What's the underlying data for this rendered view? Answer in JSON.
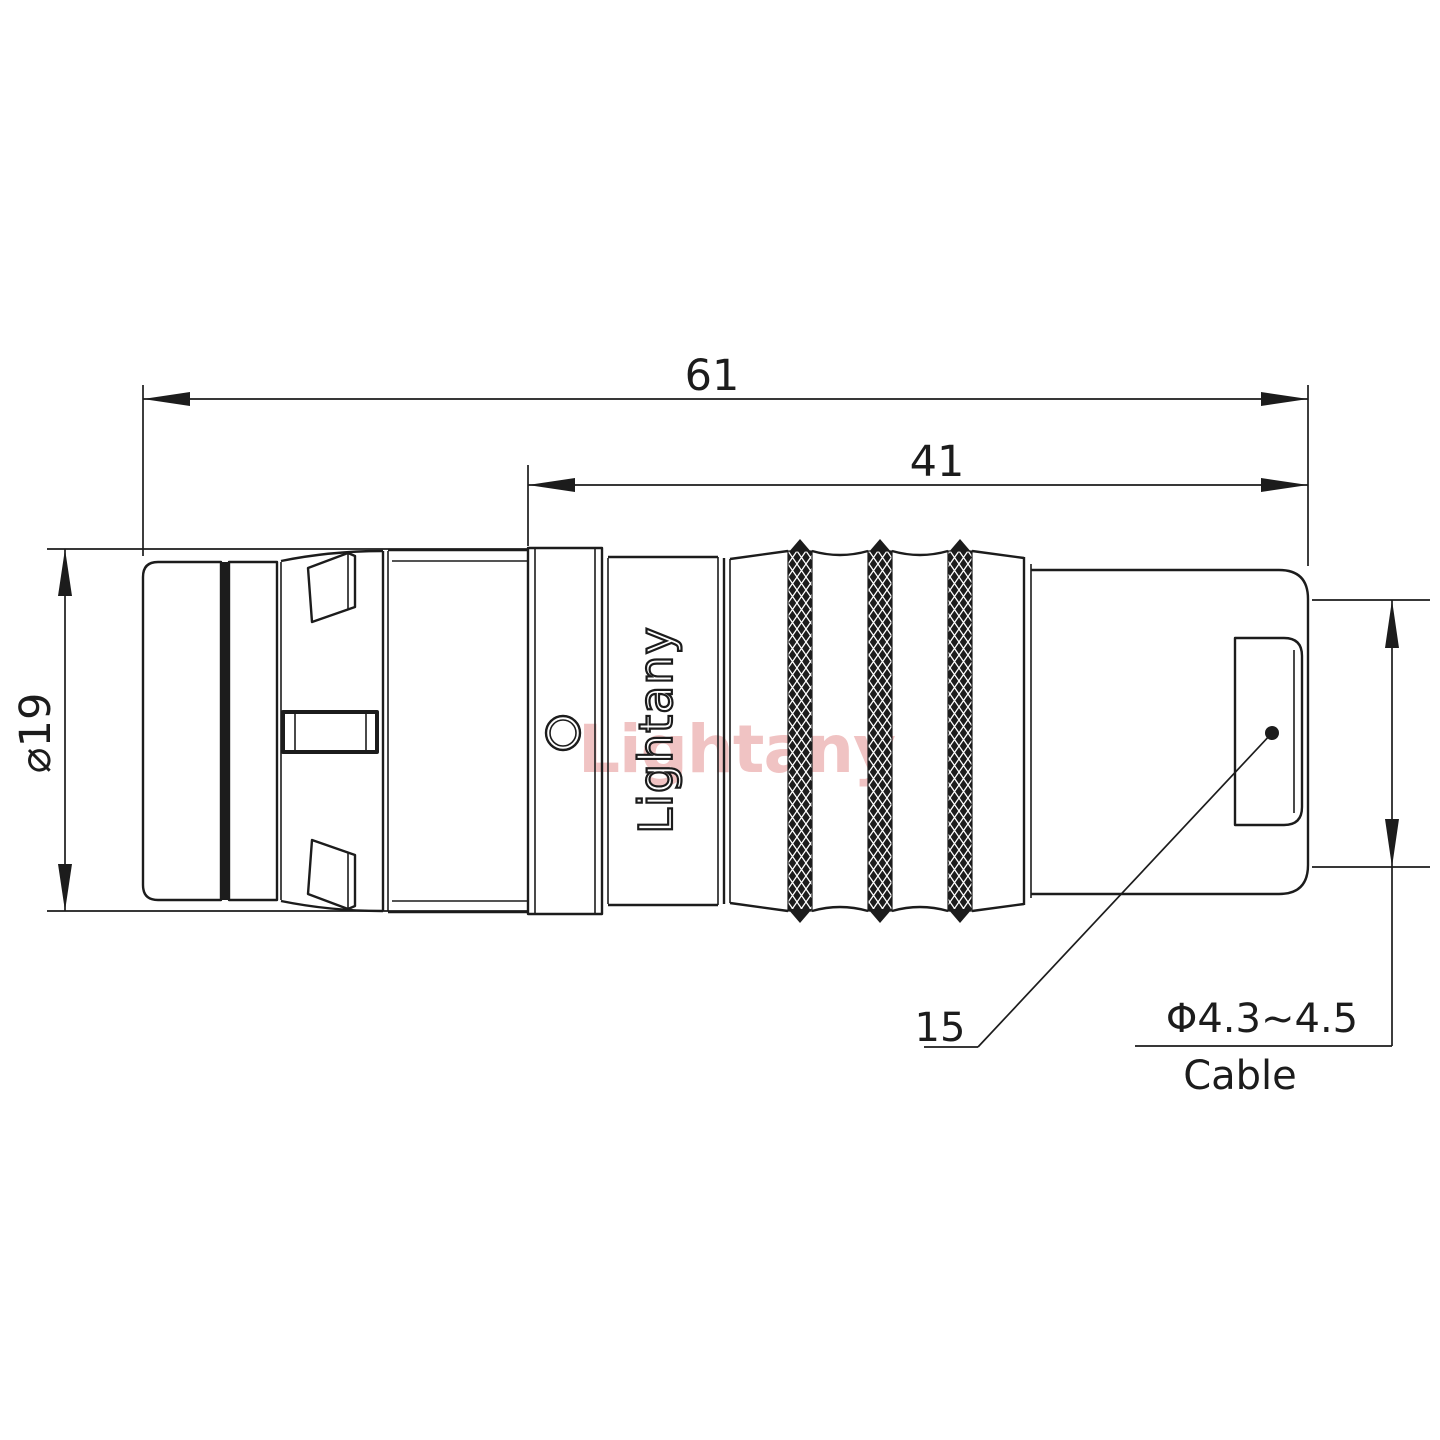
{
  "drawing": {
    "title": "connector-technical-drawing",
    "watermark_text": "Lightany",
    "engraved_text": "Lightany",
    "dimensions": {
      "overall_length": "61",
      "body_length": "41",
      "shell_diameter": "⌀19",
      "size_callout": "15",
      "cable_diameter_range": "Φ4.3~4.5",
      "cable_label": "Cable"
    },
    "colors": {
      "line": "#1c1c1c",
      "watermark": "#e59393",
      "background": "#ffffff"
    }
  }
}
